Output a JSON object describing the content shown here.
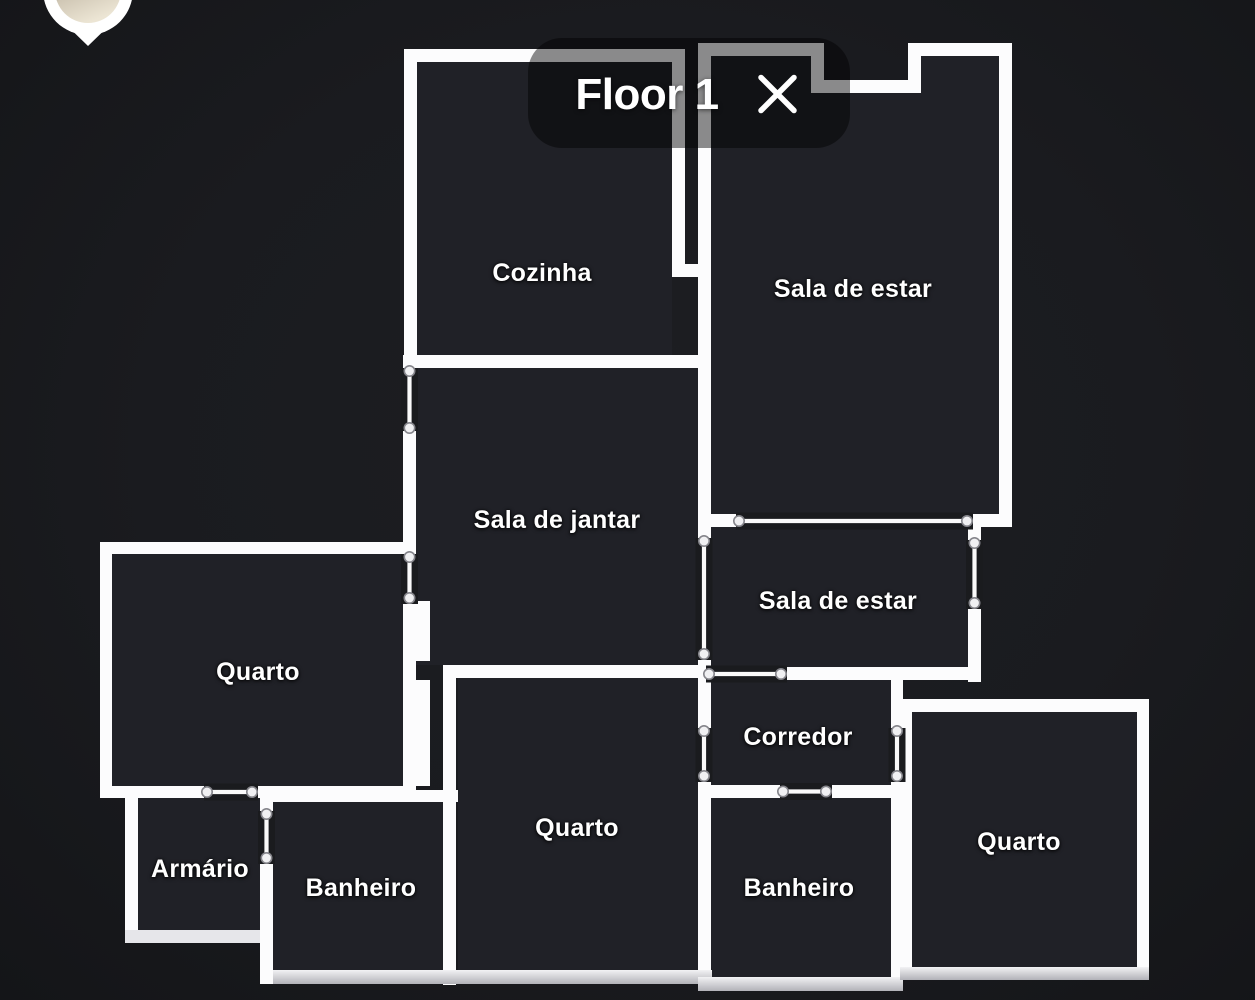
{
  "floor_selector": {
    "title": "Floor 1",
    "close_icon": "✕"
  },
  "map_pin": {
    "icon": "map-pin-with-photo"
  },
  "rooms": [
    {
      "id": "cozinha",
      "label": "Cozinha"
    },
    {
      "id": "sala-de-estar-1",
      "label": "Sala de estar"
    },
    {
      "id": "sala-de-jantar",
      "label": "Sala de jantar"
    },
    {
      "id": "quarto-oeste",
      "label": "Quarto"
    },
    {
      "id": "sala-de-estar-2",
      "label": "Sala de estar"
    },
    {
      "id": "corredor",
      "label": "Corredor"
    },
    {
      "id": "quarto-centro",
      "label": "Quarto"
    },
    {
      "id": "banheiro-1",
      "label": "Banheiro"
    },
    {
      "id": "banheiro-2",
      "label": "Banheiro"
    },
    {
      "id": "quarto-leste",
      "label": "Quarto"
    },
    {
      "id": "armario",
      "label": "Armário"
    }
  ],
  "colors": {
    "background": "#1a1b1f",
    "wall": "#fcfcfd",
    "room_fill": "#202127",
    "label_text": "#ffffff",
    "dim_overlay": "rgba(0,0,0,0.45)"
  }
}
